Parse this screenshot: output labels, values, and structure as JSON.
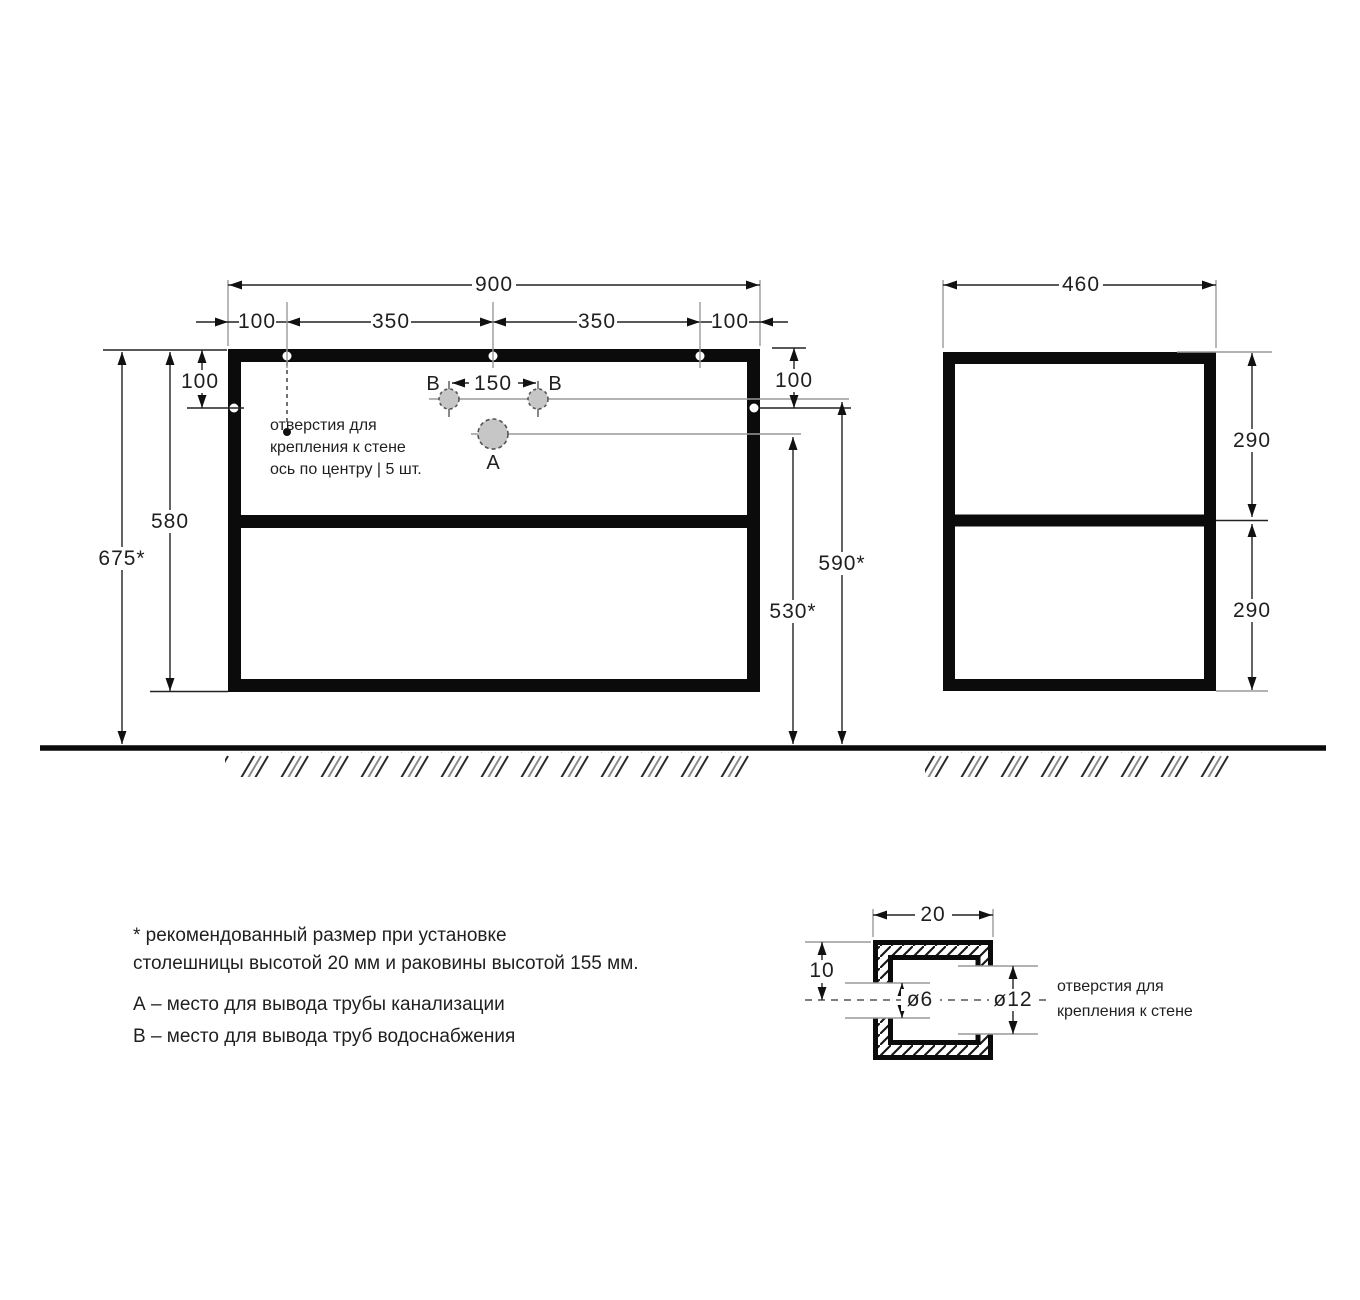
{
  "drawing_title": "cabinet-installation-drawing",
  "front_view": {
    "width_total": "900",
    "segments": [
      "100",
      "350",
      "350",
      "100"
    ],
    "offset_top_left": "100",
    "offset_top_right": "100",
    "frame_height": "580",
    "height_to_floor": "675*",
    "b_spacing": "150",
    "b_left": "B",
    "b_right": "B",
    "a_label": "A",
    "b_height_from_floor": "590*",
    "a_height_from_floor": "530*",
    "holes_note_line1": "отверстия для",
    "holes_note_line2": "крепления к стене",
    "holes_note_line3": "ось по центру  |  5 шт."
  },
  "side_view": {
    "depth_total": "460",
    "upper_section": "290",
    "lower_section": "290"
  },
  "detail": {
    "tube_width": "20",
    "half_height": "10",
    "hole_small": "ø6",
    "hole_large": "ø12",
    "note_line1": "отверстия для",
    "note_line2": "крепления к стене"
  },
  "legend": {
    "asterisk_line1": "* рекомендованный размер при установке",
    "asterisk_line2": "столешницы высотой 20 мм и раковины высотой 155 мм.",
    "line_a": "А – место для вывода трубы канализации",
    "line_b": "В – место для вывода труб водоснабжения"
  },
  "colors": {
    "line_black": "#111111",
    "line_gray": "#9a9a9a",
    "hole_fill": "#c6c6c6",
    "background": "#ffffff"
  }
}
